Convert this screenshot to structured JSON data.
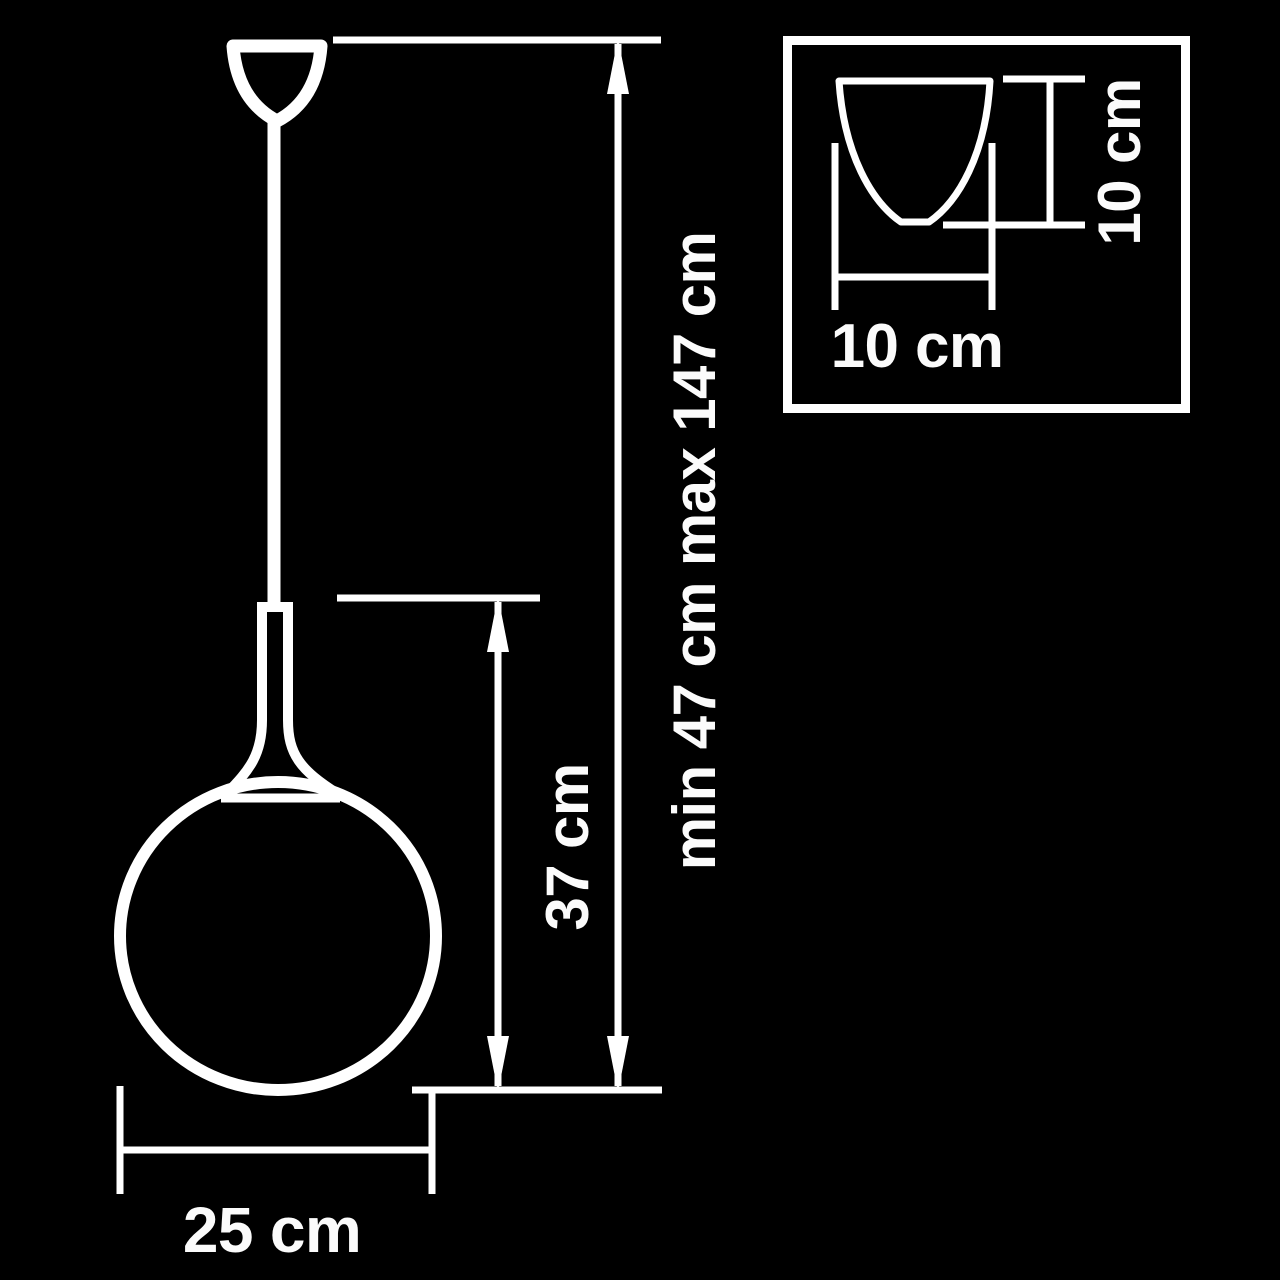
{
  "diagram": {
    "title": "pendant-lamp-dimension-drawing",
    "background_color": "#000000",
    "line_color": "#ffffff",
    "labels": {
      "height_range": "min 47 cm max 147 cm",
      "shade_height": "37 cm",
      "shade_diameter": "25 cm",
      "canopy_width": "10 cm",
      "canopy_height": "10 cm"
    },
    "values": {
      "suspension_min_cm": 47,
      "suspension_max_cm": 147,
      "shade_height_cm": 37,
      "shade_diameter_cm": 25,
      "canopy_width_cm": 10,
      "canopy_height_cm": 10
    }
  }
}
